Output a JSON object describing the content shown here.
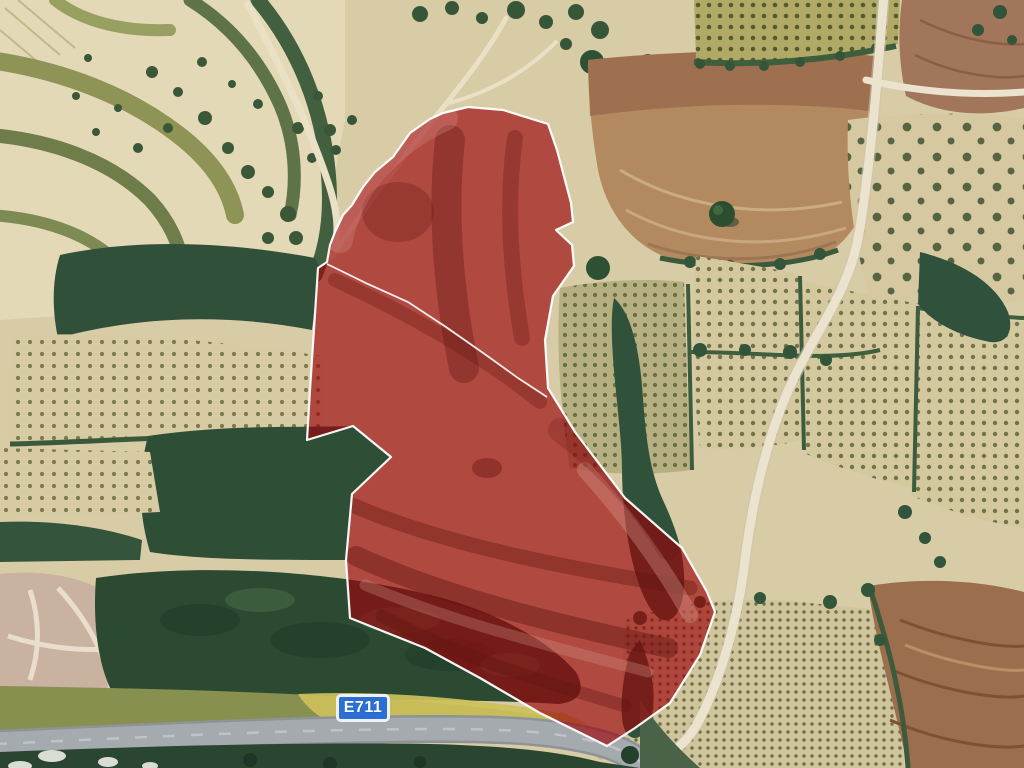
{
  "view": {
    "description": "Satellite aerial view of Mediterranean farmland with a red highlighted land parcel",
    "width_px": 1024,
    "height_px": 768
  },
  "road_badge": {
    "label": "E711",
    "background_color": "#2b6fd4",
    "border_color": "#eef2f6",
    "text_color": "#ffffff"
  },
  "parcel": {
    "plots_visible": 2,
    "fill_rgba": "rgba(155,5,10,0.66)",
    "border_color": "#ffffff",
    "outline_points": "468,107 503,110 548,124 557,150 571,203 573,222 556,230 572,245 574,266 553,296 545,340 548,388 575,432 625,498 682,548 707,592 715,612 700,655 670,703 635,728 607,746 540,713 480,678 425,648 375,628 350,618 346,560 352,494 391,457 353,426 307,440 310,390 318,268 327,262 330,245 335,232 343,215 352,205 363,187 375,172 393,157 410,133 430,119 443,113",
    "divider_points": "327,264 368,284 408,302 446,327 486,355 518,378 547,397"
  },
  "terrain_palette": {
    "field_beige": "#d8cca7",
    "olive_verge": "#87904f",
    "dark_green_trees": "#2c4a32",
    "tan_field": "#b38a60",
    "plowed_brown": "#9b6e4e",
    "highway_gray": "#a5aaae",
    "dirt_road": "#ece3cf",
    "dry_grass_yellow": "#cdc05a"
  }
}
